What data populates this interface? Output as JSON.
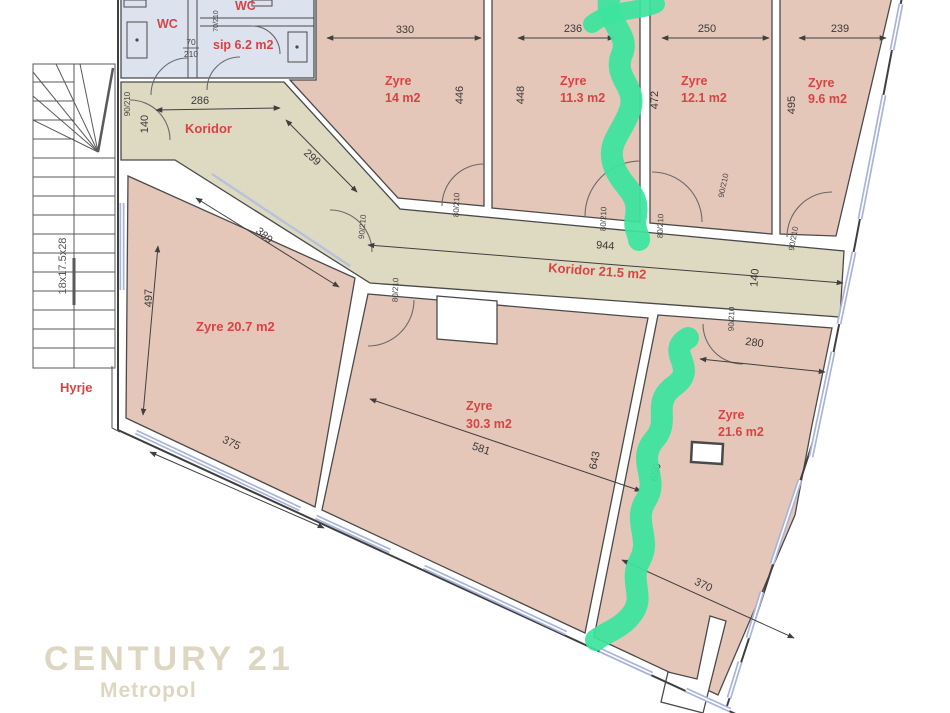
{
  "colors": {
    "room_fill": "#e5c7b9",
    "corridor_fill": "#ded9c1",
    "wc_fill": "#dde2ef",
    "wall_line": "#4a4a4a",
    "window_blue": "#a9b4d8",
    "label_red": "#d84343",
    "dim_text": "#3a3a3a",
    "marker_green": "#3ce49e",
    "watermark": "#ddd6c1"
  },
  "rooms": {
    "wc_left": {
      "label": "WC"
    },
    "wc_right": {
      "label": "WC"
    },
    "sip": {
      "label": "sip 6.2 m2"
    },
    "koridor_upper": {
      "label": "Koridor"
    },
    "koridor_main": {
      "label": "Koridor 21.5 m2"
    },
    "hyrje": {
      "label": "Hyrje"
    },
    "zyre_14": {
      "name": "Zyre",
      "area": "14 m2"
    },
    "zyre_11_3": {
      "name": "Zyre",
      "area": "11.3 m2"
    },
    "zyre_12_1": {
      "name": "Zyre",
      "area": "12.1 m2"
    },
    "zyre_9_6": {
      "name": "Zyre",
      "area": "9.6 m2"
    },
    "zyre_20_7": {
      "label": "Zyre 20.7 m2"
    },
    "zyre_30_3": {
      "name": "Zyre",
      "area": "30.3 m2"
    },
    "zyre_21_6": {
      "name": "Zyre",
      "area": "21.6 m2"
    }
  },
  "dimensions": {
    "koridor_top": "286",
    "koridor_diag": "299",
    "zyre14_width": "330",
    "zyre14_height": "446",
    "zyre113_height": "448",
    "zyre113_width": "236",
    "zyre121_height": "472",
    "zyre121_width": "250",
    "zyre96_height": "495",
    "zyre96_width": "239",
    "koridor_length": "944",
    "koridor_width": "140",
    "entry_door_width": "140",
    "zyre207_diag": "389",
    "zyre207_height": "497",
    "zyre207_width": "375",
    "zyre303_width": "581",
    "zyre303_height": "643",
    "zyre216_height": "650",
    "zyre216_top": "280",
    "zyre216_width": "370",
    "stairs_spec": "18x17.5x28"
  },
  "door_markers": {
    "d90": "90/210",
    "d80": "80/210",
    "d70": "70/210",
    "d70_num": "70",
    "d70_den": "210"
  },
  "watermark": {
    "brand": "CENTURY 21",
    "dot": ".",
    "sub": "Metropol"
  }
}
